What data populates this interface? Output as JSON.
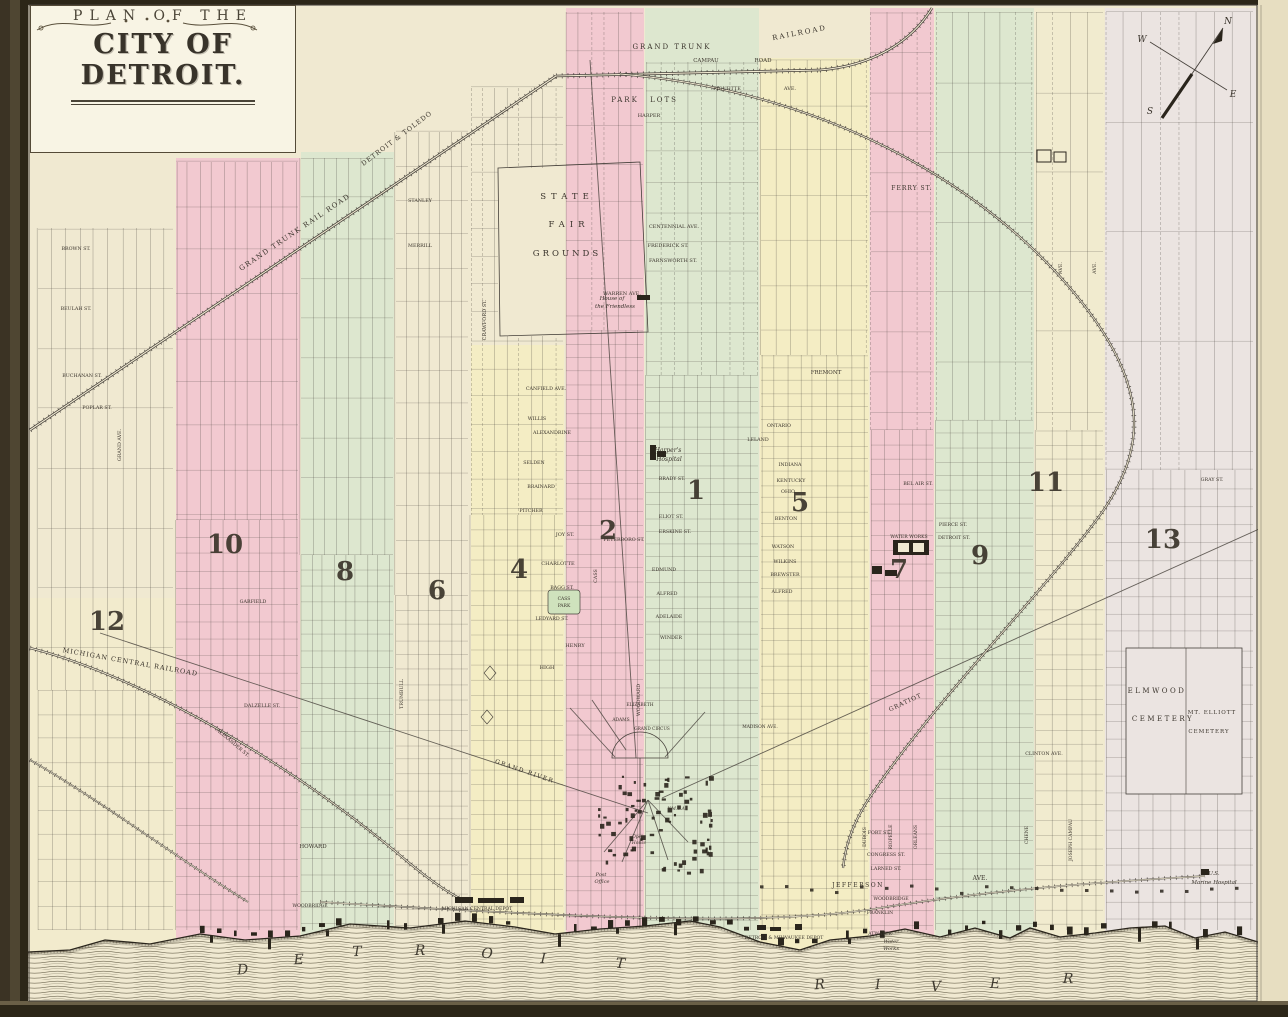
{
  "map": {
    "title_line1": "PLAN OF THE",
    "title_line2": "CITY OF DETROIT.",
    "compass": {
      "n": "N",
      "e": "E",
      "s": "S",
      "w": "W"
    },
    "colors": {
      "parchment": "#f0e9d1",
      "page_edge": "#e7dec1",
      "pink": "#f2c9d0",
      "green": "#dde7cf",
      "yellow": "#f4edc4",
      "cream2": "#f1ebcf",
      "lavender": "#ebe4e1",
      "yellow2": "#f3edc9",
      "park": "#cfe2bd",
      "line": "#45403a",
      "ink": "#2a251c",
      "water": "#6f6852",
      "frame_dark": "#2c2618",
      "frame_mid": "#554b37",
      "title_bg": "#f8f4e4"
    },
    "bands": [
      {
        "x": 176,
        "w": 124,
        "top": 158,
        "c": "pink"
      },
      {
        "x": 301,
        "w": 93,
        "top": 152,
        "c": "green"
      },
      {
        "x": 471,
        "w": 93,
        "top": 345,
        "c": "yellow"
      },
      {
        "x": 566,
        "w": 78,
        "top": 8,
        "c": "pink"
      },
      {
        "x": 645,
        "w": 114,
        "top": 8,
        "c": "green"
      },
      {
        "x": 760,
        "w": 109,
        "top": 58,
        "c": "yellow"
      },
      {
        "x": 870,
        "w": 64,
        "top": 8,
        "c": "pink"
      },
      {
        "x": 935,
        "w": 99,
        "top": 8,
        "c": "green"
      },
      {
        "x": 1035,
        "w": 69,
        "top": 8,
        "c": "cream2"
      },
      {
        "x": 1105,
        "w": 151,
        "top": 8,
        "c": "lavender"
      },
      {
        "x": 30,
        "w": 146,
        "top": 598,
        "c": "yellow2",
        "o": 0.5
      }
    ],
    "wards": [
      {
        "n": "12",
        "x": 107,
        "y": 630
      },
      {
        "n": "10",
        "x": 225,
        "y": 553
      },
      {
        "n": "8",
        "x": 345,
        "y": 580
      },
      {
        "n": "6",
        "x": 437,
        "y": 599
      },
      {
        "n": "4",
        "x": 519,
        "y": 578
      },
      {
        "n": "2",
        "x": 608,
        "y": 539
      },
      {
        "n": "1",
        "x": 696,
        "y": 499
      },
      {
        "n": "5",
        "x": 800,
        "y": 511
      },
      {
        "n": "7",
        "x": 899,
        "y": 578
      },
      {
        "n": "9",
        "x": 980,
        "y": 564
      },
      {
        "n": "11",
        "x": 1046,
        "y": 491
      },
      {
        "n": "13",
        "x": 1163,
        "y": 548
      }
    ],
    "river": {
      "word1": "DETROIT",
      "p1": [
        [
          243,
          974
        ],
        [
          299,
          964
        ],
        [
          357,
          956
        ],
        [
          420,
          955
        ],
        [
          487,
          958
        ],
        [
          543,
          963
        ],
        [
          620,
          968
        ]
      ],
      "word2": "RIVER",
      "p2": [
        [
          820,
          989
        ],
        [
          878,
          989
        ],
        [
          936,
          991
        ],
        [
          995,
          988
        ],
        [
          1068,
          983
        ]
      ]
    },
    "labels": [
      {
        "t": "GRAND TRUNK",
        "x": 672,
        "y": 49,
        "s": 7,
        "ls": 2
      },
      {
        "t": "RAILROAD",
        "x": 800,
        "y": 35,
        "r": -11,
        "s": 7,
        "ls": 2
      },
      {
        "t": "CAMPAU",
        "x": 706,
        "y": 62,
        "s": 5.5
      },
      {
        "t": "ROAD",
        "x": 763,
        "y": 62,
        "s": 5.5
      },
      {
        "t": "PARK",
        "x": 625,
        "y": 102,
        "s": 7,
        "ls": 2
      },
      {
        "t": "LOTS",
        "x": 664,
        "y": 102,
        "s": 7,
        "ls": 2
      },
      {
        "t": "HARPER",
        "x": 649,
        "y": 117,
        "s": 5
      },
      {
        "t": "PIQUETTE",
        "x": 727,
        "y": 90,
        "s": 5
      },
      {
        "t": "AVE.",
        "x": 790,
        "y": 90,
        "s": 5
      },
      {
        "t": "FERRY ST.",
        "x": 912,
        "y": 190,
        "s": 6,
        "ls": 1
      },
      {
        "t": "DETROIT & TOLEDO",
        "x": 398,
        "y": 140,
        "r": -37,
        "s": 6.5,
        "ls": 1
      },
      {
        "t": "GRAND TRUNK RAIL ROAD",
        "x": 296,
        "y": 234,
        "r": -34,
        "s": 7,
        "ls": 1.5
      },
      {
        "t": "STANLEY",
        "x": 420,
        "y": 202,
        "s": 4.8
      },
      {
        "t": "MERRILL",
        "x": 420,
        "y": 247,
        "s": 4.8
      },
      {
        "t": "CRAWFORD ST.",
        "x": 486,
        "y": 320,
        "r": -90,
        "s": 5
      },
      {
        "t": "STATE",
        "x": 567,
        "y": 199,
        "s": 8.5,
        "ls": 5
      },
      {
        "t": "FAIR",
        "x": 569,
        "y": 227,
        "s": 8.5,
        "ls": 5
      },
      {
        "t": "GROUNDS",
        "x": 567,
        "y": 256,
        "s": 8.5,
        "ls": 3
      },
      {
        "t": "CENTENNIAL AVE.",
        "x": 674,
        "y": 228,
        "s": 5
      },
      {
        "t": "FREDERICK ST.",
        "x": 668,
        "y": 247,
        "s": 5
      },
      {
        "t": "FARNSWORTH ST.",
        "x": 673,
        "y": 262,
        "s": 5
      },
      {
        "t": "WARREN AVE.",
        "x": 622,
        "y": 295,
        "s": 5
      },
      {
        "t": "House of",
        "x": 612,
        "y": 300,
        "i": 1,
        "s": 5.5
      },
      {
        "t": "the Friendless",
        "x": 615,
        "y": 308,
        "i": 1,
        "s": 5.5
      },
      {
        "t": "FREMONT",
        "x": 826,
        "y": 374,
        "s": 5.5
      },
      {
        "t": "BROWN ST.",
        "x": 76,
        "y": 250,
        "s": 4.8
      },
      {
        "t": "BEULAH ST.",
        "x": 76,
        "y": 310,
        "s": 4.8
      },
      {
        "t": "BUCHANAN ST.",
        "x": 82,
        "y": 377,
        "s": 4.8
      },
      {
        "t": "POPLAR ST.",
        "x": 97,
        "y": 409,
        "s": 4.8
      },
      {
        "t": "GRAND AVE.",
        "x": 121,
        "y": 445,
        "r": -90,
        "s": 4.8
      },
      {
        "t": "MICHIGAN CENTRAL RAILROAD",
        "x": 130,
        "y": 664,
        "r": 10,
        "s": 6.5,
        "ls": 1
      },
      {
        "t": "GARFIELD",
        "x": 253,
        "y": 603,
        "s": 4.8
      },
      {
        "t": "DALZELLE ST.",
        "x": 262,
        "y": 707,
        "s": 4.8
      },
      {
        "t": "ALEXANDER ST.",
        "x": 232,
        "y": 744,
        "r": 40,
        "s": 4.8
      },
      {
        "t": "CANFIELD AVE.",
        "x": 546,
        "y": 390,
        "s": 4.8
      },
      {
        "t": "WILLIS",
        "x": 537,
        "y": 420,
        "s": 4.8
      },
      {
        "t": "ALEXANDRINE",
        "x": 552,
        "y": 434,
        "s": 4.8
      },
      {
        "t": "SELDEN",
        "x": 534,
        "y": 464,
        "s": 4.8
      },
      {
        "t": "BRAINARD",
        "x": 541,
        "y": 488,
        "s": 4.8
      },
      {
        "t": "PITCHER",
        "x": 531,
        "y": 512,
        "s": 4.8
      },
      {
        "t": "JOY ST.",
        "x": 565,
        "y": 536,
        "s": 5
      },
      {
        "t": "PETERBORO ST.",
        "x": 624,
        "y": 541,
        "s": 4.8
      },
      {
        "t": "CHARLOTTE",
        "x": 558,
        "y": 565,
        "s": 5
      },
      {
        "t": "BAGG ST.",
        "x": 562,
        "y": 589,
        "s": 4.8
      },
      {
        "t": "CASS",
        "x": 564,
        "y": 600,
        "s": 4.5
      },
      {
        "t": "PARK",
        "x": 564,
        "y": 607,
        "s": 4.5
      },
      {
        "t": "LEDYARD ST.",
        "x": 552,
        "y": 620,
        "s": 4.8
      },
      {
        "t": "HENRY",
        "x": 575,
        "y": 647,
        "s": 5
      },
      {
        "t": "HIGH",
        "x": 547,
        "y": 669,
        "s": 5
      },
      {
        "t": "CASS",
        "x": 597,
        "y": 576,
        "r": -90,
        "s": 4.8
      },
      {
        "t": "WOODWARD",
        "x": 640,
        "y": 700,
        "r": -90,
        "s": 4.8
      },
      {
        "t": "EDMUND",
        "x": 664,
        "y": 571,
        "s": 4.8
      },
      {
        "t": "ALFRED",
        "x": 667,
        "y": 595,
        "s": 4.8
      },
      {
        "t": "ADELAIDE",
        "x": 669,
        "y": 618,
        "s": 4.8
      },
      {
        "t": "WINDER",
        "x": 671,
        "y": 639,
        "s": 4.8
      },
      {
        "t": "BRADY ST.",
        "x": 672,
        "y": 480,
        "s": 4.8
      },
      {
        "t": "ELIOT ST.",
        "x": 671,
        "y": 518,
        "s": 4.8
      },
      {
        "t": "ERSKINE ST.",
        "x": 675,
        "y": 533,
        "s": 4.8
      },
      {
        "t": "Harper's",
        "x": 668,
        "y": 452,
        "i": 1,
        "s": 6
      },
      {
        "t": "Hospital",
        "x": 669,
        "y": 461,
        "i": 1,
        "s": 6
      },
      {
        "t": "ONTARIO",
        "x": 779,
        "y": 427,
        "s": 4.8
      },
      {
        "t": "LELAND",
        "x": 758,
        "y": 441,
        "s": 4.8
      },
      {
        "t": "INDIANA",
        "x": 790,
        "y": 466,
        "s": 4.8
      },
      {
        "t": "KENTUCKY",
        "x": 791,
        "y": 482,
        "s": 4.8
      },
      {
        "t": "OHIO",
        "x": 788,
        "y": 493,
        "s": 4.8
      },
      {
        "t": "BENTON",
        "x": 786,
        "y": 520,
        "s": 4.8
      },
      {
        "t": "WATSON",
        "x": 783,
        "y": 548,
        "s": 4.8
      },
      {
        "t": "WILKINS",
        "x": 785,
        "y": 563,
        "s": 4.8
      },
      {
        "t": "BREWSTER",
        "x": 785,
        "y": 576,
        "s": 4.8
      },
      {
        "t": "ALFRED",
        "x": 782,
        "y": 593,
        "s": 4.8
      },
      {
        "t": "BEL AIR ST.",
        "x": 918,
        "y": 485,
        "s": 4.8
      },
      {
        "t": "PIERCE ST.",
        "x": 953,
        "y": 526,
        "s": 4.8
      },
      {
        "t": "DETROIT ST.",
        "x": 954,
        "y": 539,
        "s": 4.8
      },
      {
        "t": "WATER WORKS",
        "x": 909,
        "y": 538,
        "s": 4.6
      },
      {
        "t": "GRATIOT",
        "x": 906,
        "y": 704,
        "r": -25,
        "s": 6,
        "ls": 1
      },
      {
        "t": "GRAY ST.",
        "x": 1212,
        "y": 481,
        "s": 4.8
      },
      {
        "t": "CLINTON AVE.",
        "x": 1044,
        "y": 755,
        "s": 4.8
      },
      {
        "t": "AVE.",
        "x": 1062,
        "y": 268,
        "r": -90,
        "s": 4.8
      },
      {
        "t": "AVE.",
        "x": 1096,
        "y": 268,
        "r": -90,
        "s": 4.8
      },
      {
        "t": "ELMWOOD",
        "x": 1157,
        "y": 693,
        "s": 7,
        "ls": 2.5
      },
      {
        "t": "CEMETERY",
        "x": 1163,
        "y": 721,
        "s": 7,
        "ls": 2.5
      },
      {
        "t": "MT. ELLIOTT",
        "x": 1212,
        "y": 714,
        "s": 5.5,
        "ls": 1
      },
      {
        "t": "CEMETERY",
        "x": 1209,
        "y": 733,
        "s": 5.5,
        "ls": 1
      },
      {
        "t": "U.S.",
        "x": 1214,
        "y": 875,
        "i": 1,
        "s": 5.5
      },
      {
        "t": "Marine Hospital",
        "x": 1214,
        "y": 884,
        "i": 1,
        "s": 5.5
      },
      {
        "t": "HOWARD",
        "x": 313,
        "y": 848,
        "s": 5.5
      },
      {
        "t": "WOODBRIDGE",
        "x": 310,
        "y": 907,
        "s": 4.6
      },
      {
        "t": "MICHIGAN CENTRAL DEPOT",
        "x": 477,
        "y": 910,
        "s": 4.6
      },
      {
        "t": "FORT ST.",
        "x": 879,
        "y": 834,
        "s": 4.8
      },
      {
        "t": "CONGRESS ST.",
        "x": 886,
        "y": 856,
        "s": 4.8
      },
      {
        "t": "LARNED ST.",
        "x": 886,
        "y": 870,
        "s": 4.8
      },
      {
        "t": "JEFFERSON",
        "x": 858,
        "y": 887,
        "s": 6,
        "ls": 1.5
      },
      {
        "t": "AVE.",
        "x": 980,
        "y": 880,
        "s": 6
      },
      {
        "t": "WOODBRIDGE",
        "x": 891,
        "y": 900,
        "s": 4.6
      },
      {
        "t": "FRANKLIN",
        "x": 880,
        "y": 914,
        "s": 4.6
      },
      {
        "t": "ATWATER",
        "x": 880,
        "y": 935,
        "s": 4.6
      },
      {
        "t": "DETROIT & MILWAUKEE DEPOT",
        "x": 784,
        "y": 939,
        "s": 4.6
      },
      {
        "t": "Water",
        "x": 891,
        "y": 943,
        "i": 1,
        "s": 5
      },
      {
        "t": "Works",
        "x": 891,
        "y": 950,
        "i": 1,
        "s": 5
      },
      {
        "t": "DUBOIS",
        "x": 866,
        "y": 837,
        "r": -90,
        "s": 4.6
      },
      {
        "t": "RIOPELLE",
        "x": 892,
        "y": 837,
        "r": -90,
        "s": 4.6
      },
      {
        "t": "ORLEANS",
        "x": 917,
        "y": 837,
        "r": -90,
        "s": 4.6
      },
      {
        "t": "CHENE",
        "x": 1028,
        "y": 835,
        "r": -90,
        "s": 4.6
      },
      {
        "t": "JOSEPH CAMPAU",
        "x": 1072,
        "y": 840,
        "r": -90,
        "s": 4.6
      },
      {
        "t": "TRUMBULL",
        "x": 403,
        "y": 694,
        "r": -90,
        "s": 4.8
      },
      {
        "t": "GRAND RIVER",
        "x": 524,
        "y": 773,
        "r": 19,
        "s": 6,
        "ls": 1.5
      },
      {
        "t": "ELIZABETH",
        "x": 640,
        "y": 706,
        "s": 4.4
      },
      {
        "t": "ADAMS",
        "x": 621,
        "y": 721,
        "s": 4.4
      },
      {
        "t": "GRAND CIRCUS",
        "x": 652,
        "y": 730,
        "s": 4.2
      },
      {
        "t": "MADISON AVE.",
        "x": 760,
        "y": 728,
        "s": 4.4
      },
      {
        "t": "Y.M.C.A.",
        "x": 677,
        "y": 810,
        "i": 1,
        "s": 4.4
      },
      {
        "t": "Opera",
        "x": 639,
        "y": 838,
        "i": 1,
        "s": 4.4
      },
      {
        "t": "House",
        "x": 639,
        "y": 844,
        "i": 1,
        "s": 4.4
      },
      {
        "t": "Post",
        "x": 601,
        "y": 876,
        "i": 1,
        "s": 5
      },
      {
        "t": "Office",
        "x": 602,
        "y": 883,
        "i": 1,
        "s": 5
      }
    ]
  }
}
